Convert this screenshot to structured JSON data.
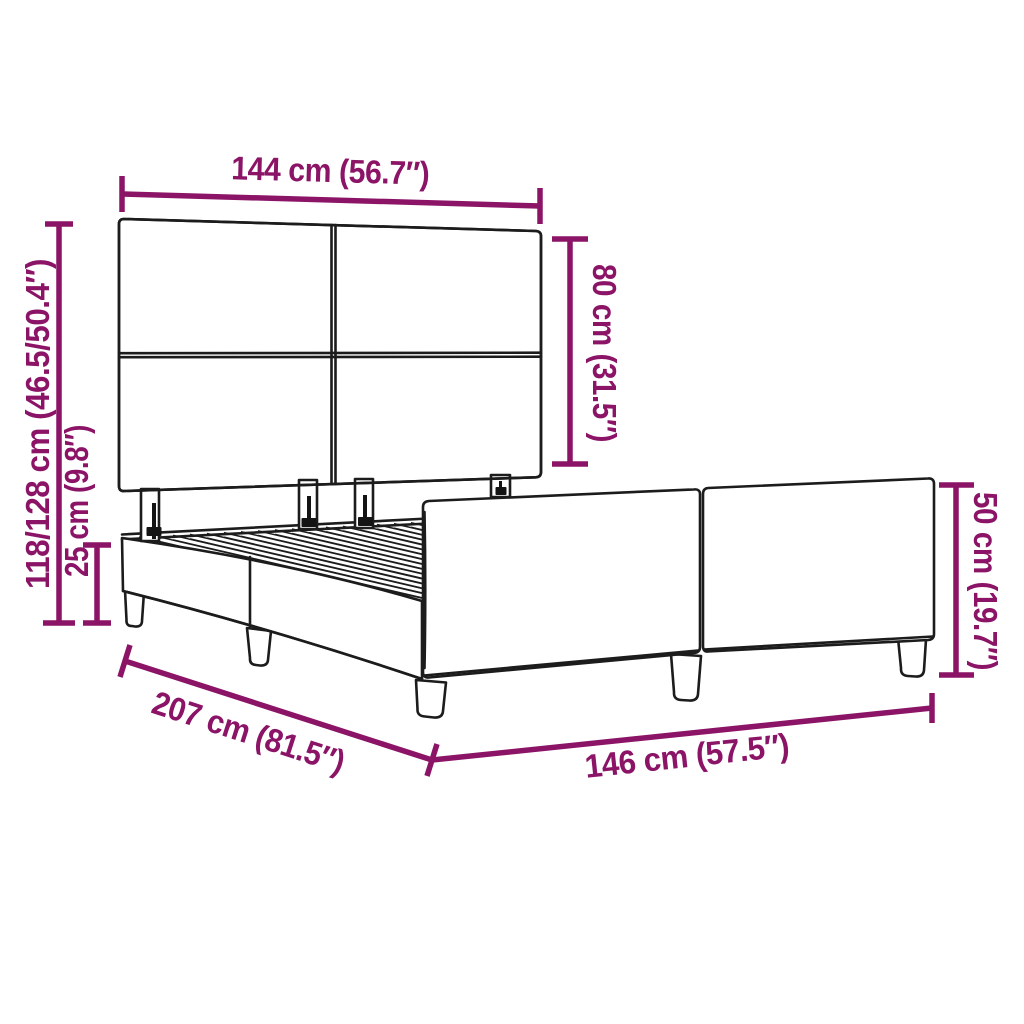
{
  "diagram": {
    "name": "Bed frame with tufted headboard – dimension drawing",
    "colors": {
      "dimension_accent": "#8B1467",
      "linework": "#1C1C1C",
      "background": "#FFFFFF"
    },
    "labels": {
      "headboard_width": "144 cm (56.7″)",
      "total_height": "118/128 cm (46.5/50.4″)",
      "base_height": "25 cm (9.8″)",
      "headboard_panel_height": "80 cm (31.5″)",
      "footend_height": "50 cm (19.7″)",
      "frame_length": "207 cm (81.5″)",
      "frame_width": "146 cm (57.5″)"
    }
  }
}
